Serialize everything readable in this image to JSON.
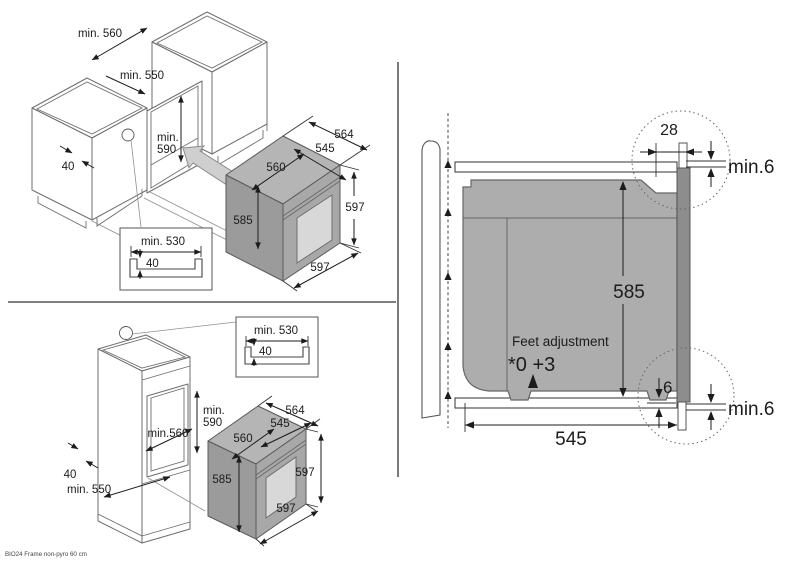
{
  "footer_note": "BIO24 Frame non-pyro 60 cm",
  "oven_dims": {
    "top_depth": "564",
    "inner_depth": "545",
    "top_width": "560",
    "body_height": "585",
    "front_height": "597",
    "front_width": "597"
  },
  "channel_inset": {
    "width": "min. 530",
    "depth": "40"
  },
  "top_scene": {
    "niche_width": "min. 560",
    "niche_depth": "min. 550",
    "niche_height_1": "min.",
    "niche_height_2": "590",
    "front_rail": "40"
  },
  "bottom_scene": {
    "niche_height_1": "min.",
    "niche_height_2": "590",
    "niche_width": "min.560",
    "front_rail": "40",
    "niche_depth": "min. 550"
  },
  "side_scene": {
    "front_offset": "28",
    "top_clearance": "min.6",
    "body_height": "585",
    "bottom_gap": "6",
    "bottom_clearance": "min.6",
    "depth": "545",
    "feet_label": "Feet adjustment",
    "feet_range": "*0 +3"
  }
}
